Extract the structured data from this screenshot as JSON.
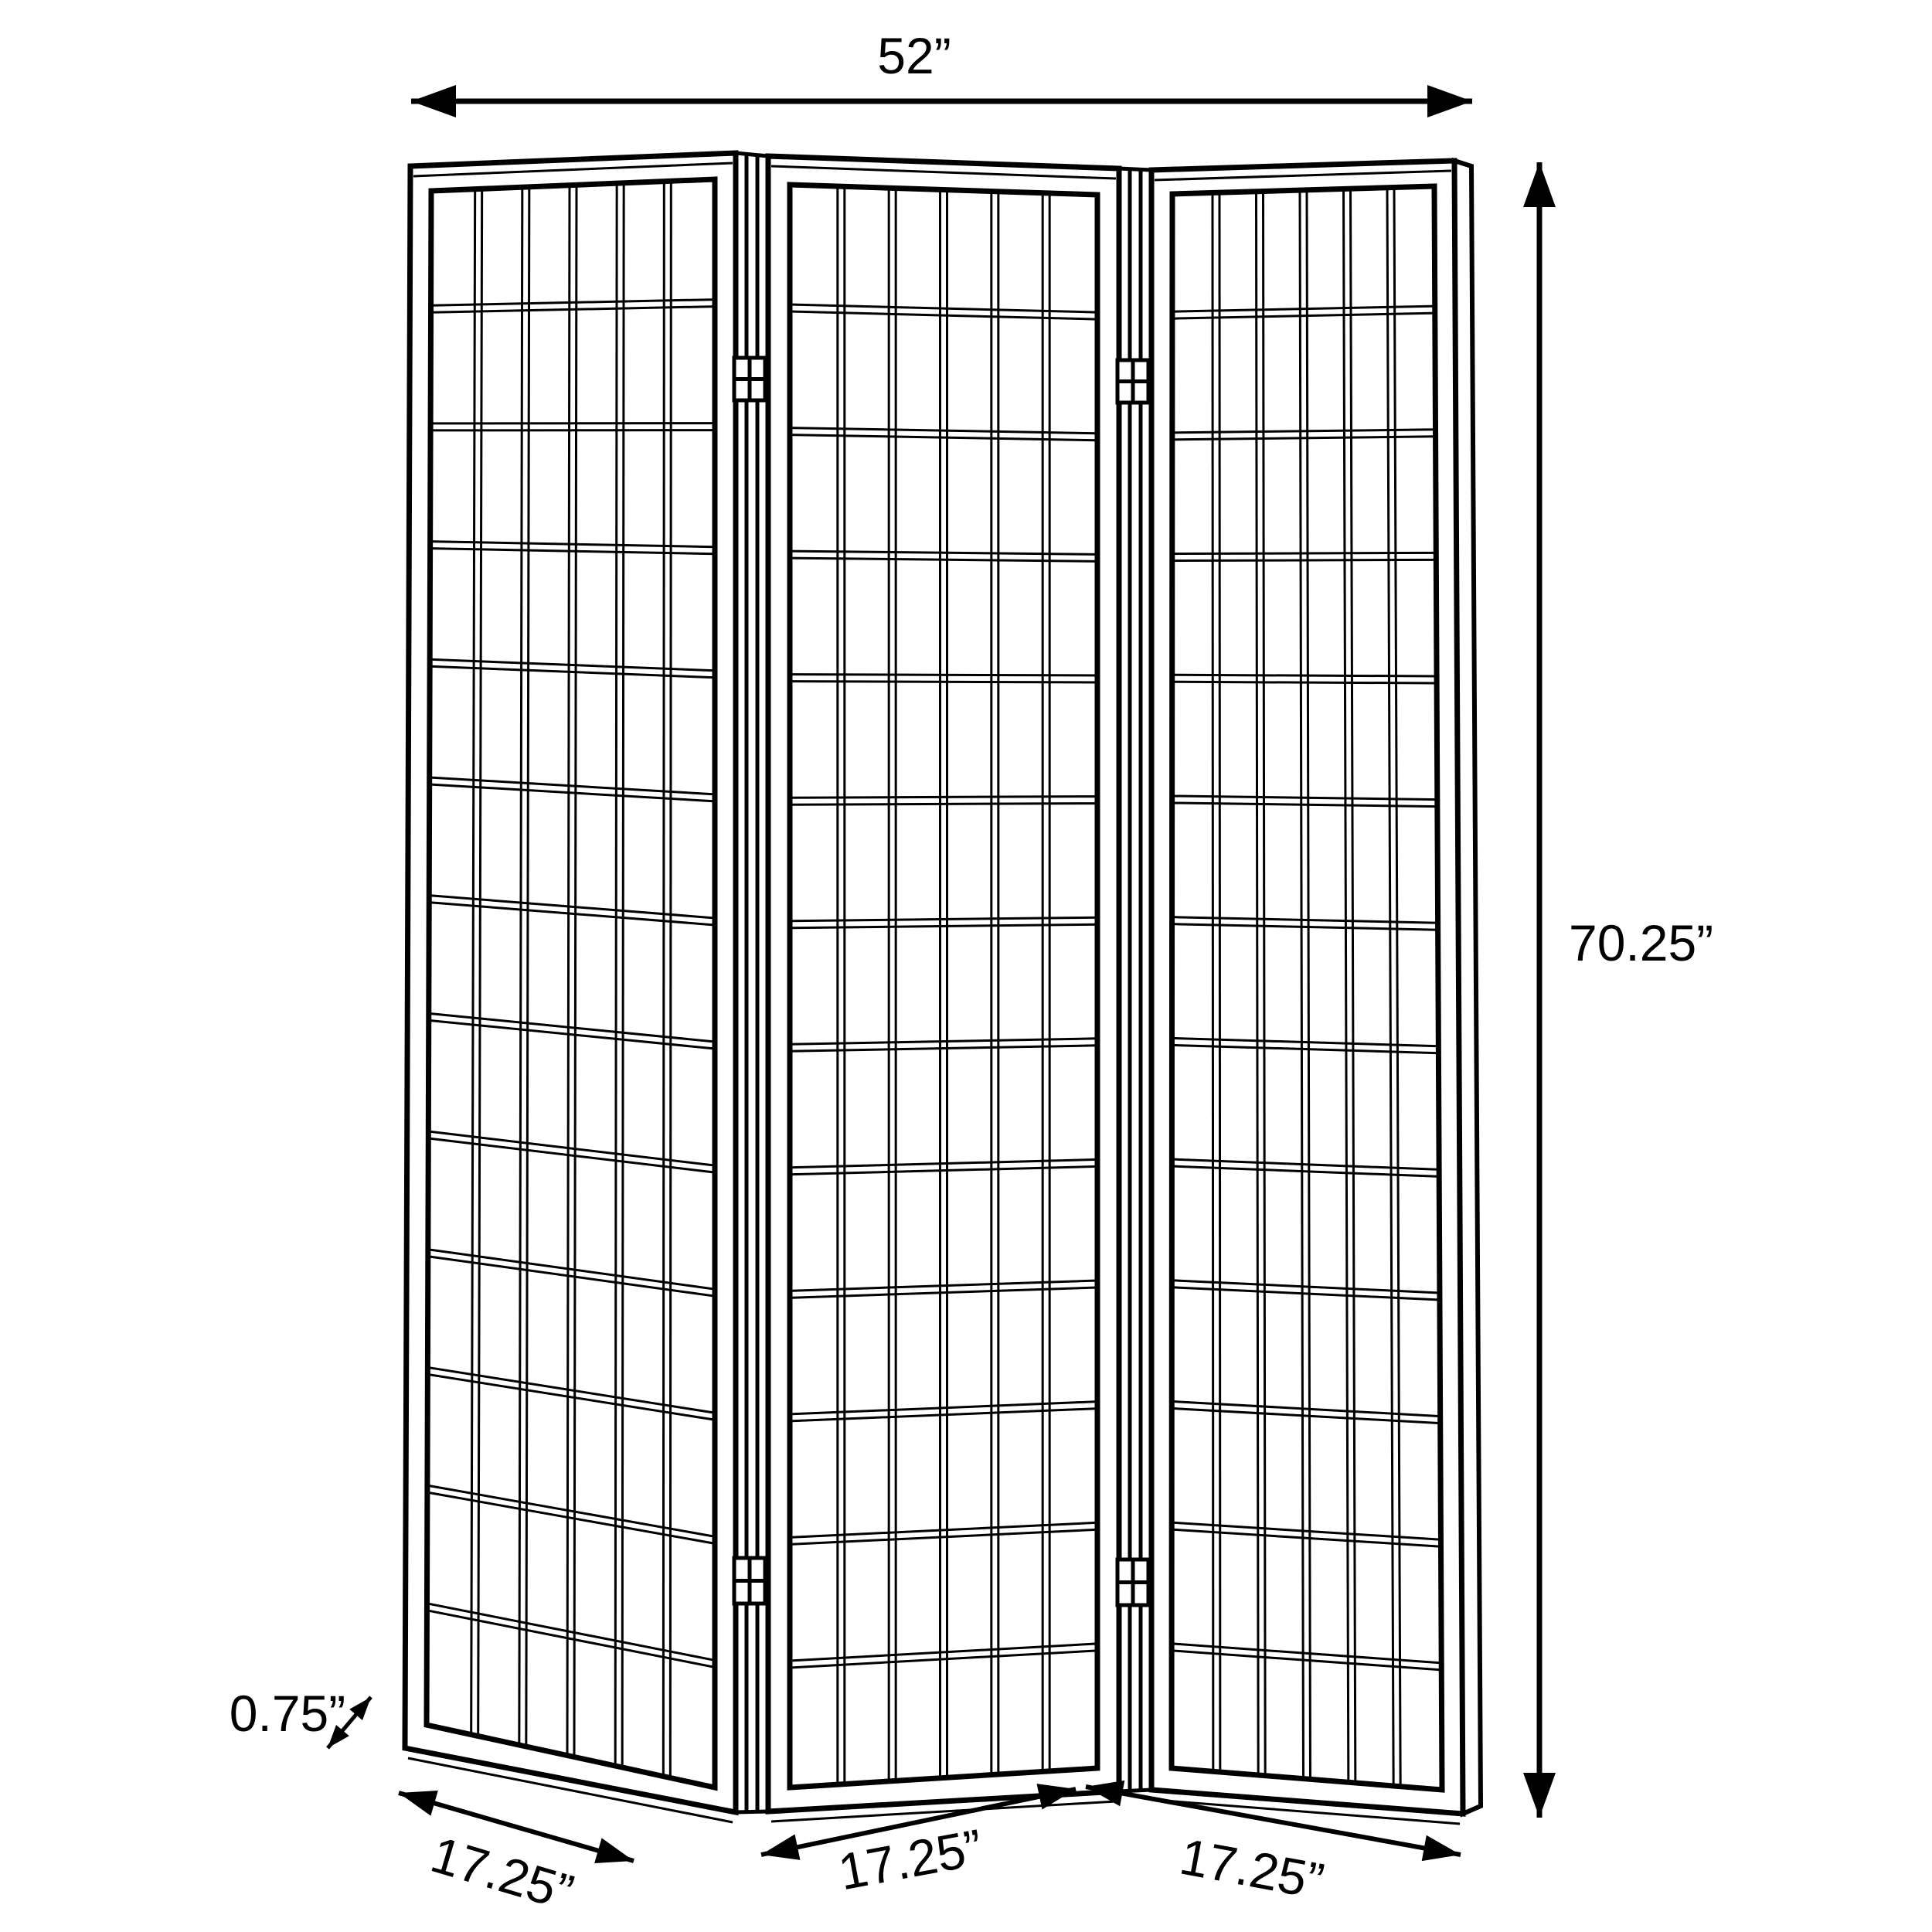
{
  "diagram": {
    "subject": "three-panel folding room divider screen, dimension line drawing",
    "style": "black line art on white background"
  },
  "dimensions": {
    "width": {
      "label": "52”"
    },
    "height": {
      "label": "70.25”"
    },
    "thickness": {
      "label": "0.75”"
    },
    "panel_widths": [
      "17.25”",
      "17.25”",
      "17.25”"
    ]
  },
  "screen": {
    "panel_count": 3,
    "lattice_columns_per_panel": 6,
    "lattice_rows_per_panel": 13,
    "hinge_count": 4
  },
  "colors": {
    "line": "#000000",
    "background": "#ffffff"
  }
}
